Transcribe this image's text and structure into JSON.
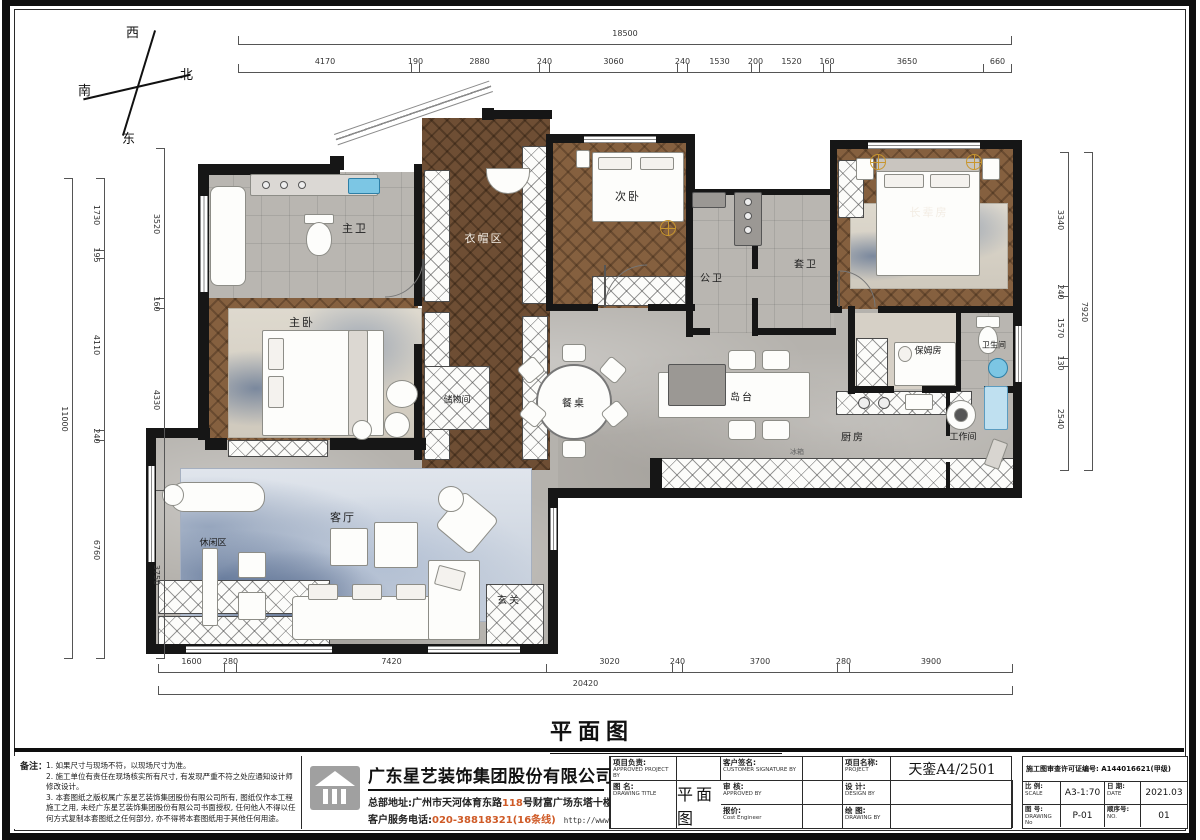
{
  "compass": {
    "west": "西",
    "north": "北",
    "south": "南",
    "east": "东"
  },
  "dims": {
    "top_total": "18500",
    "top": [
      "4170",
      "190",
      "2880",
      "240",
      "3060",
      "240",
      "1530",
      "200",
      "1520",
      "160",
      "3650",
      "660"
    ],
    "bottom_total": "20420",
    "bottom": [
      "1600",
      "280",
      "7420",
      "3020",
      "240",
      "3700",
      "280",
      "3900"
    ],
    "left_total": "11000",
    "left_outer": [
      "1730",
      "195",
      "4110",
      "240",
      "6760"
    ],
    "left_inner": [
      "3520",
      "160",
      "4330",
      "3750"
    ],
    "right_total": "7920",
    "right": [
      "3340",
      "240",
      "1570",
      "130",
      "2540"
    ]
  },
  "rooms": {
    "master_bath": "主卫",
    "cloak": "衣帽区",
    "second_bed": "次卧",
    "public_bath": "公卫",
    "suite_bath": "套卫",
    "elder_room": "长辈房",
    "master_bed": "主卧",
    "storage": "储物间",
    "dining_table": "餐桌",
    "island": "岛台",
    "nanny_room": "保姆房",
    "bathroom": "卫生间",
    "kitchen": "厨房",
    "work_room": "工作间",
    "living": "客厅",
    "leisure": "休闲区",
    "entry": "玄关",
    "fridge": "冰箱"
  },
  "title": {
    "text": "平面图",
    "scale": "1:70"
  },
  "notes": {
    "heading": "备注：",
    "line1": "1. 如果尺寸与现场不符，以现场尺寸为准。",
    "line2": "2. 施工单位有责任在现场核实所有尺寸, 有发现严重不符之处应通知设计师修改设计。",
    "line3": "3. 本套图纸之版权属广东星艺装饰集团股份有限公司所有, 图纸仅作本工程施工之用, 未经广东星艺装饰集团股份有限公司书面授权, 任何他人不得以任何方式复制本套图纸之任何部分, 亦不得将本套图纸用于其他任何用途。"
  },
  "company": {
    "name": "广东星艺装饰集团股份有限公司",
    "address_prefix": "总部地址:广州市天河体育东路",
    "address_highlight": "118",
    "address_suffix": "号财富广场东塔十楼",
    "phone_label": "客户服务电话:",
    "phone_number": "020-38818321(16条线)",
    "website": "http://www.xingyigz.com.cn"
  },
  "titleblock": {
    "approved_project_cn": "项目负责:",
    "approved_project_en": "APPROVED PROJECT BY",
    "customer_cn": "客户签名:",
    "customer_en": "CUSTOMER SIGNATURE BY",
    "review_cn": "审 核:",
    "review_en": "APPROVED BY",
    "design_cn": "设 计:",
    "design_en": "DESIGN BY",
    "cost_cn": "报价:",
    "cost_en": "Cost Engineer",
    "drawing_by_cn": "绘 图:",
    "drawing_by_en": "DRAWING BY",
    "project_cn": "项目名称:",
    "project_en": "PROJECT",
    "project_value": "天銮A4/2501",
    "drawing_title_cn": "图 名:",
    "drawing_title_en": "DRAWING  TITLE",
    "drawing_title_value": "平面图",
    "permit": "施工图审查许可证编号: A144016621(甲级)",
    "scale_cn": "比 例:",
    "scale_en": "SCALE",
    "scale_value": "A3-1:70",
    "date_cn": "日 期:",
    "date_en": "DATE",
    "date_value": "2021.03",
    "drawing_no_cn": "图 号:",
    "drawing_no_en": "DRAWING No",
    "drawing_no_value": "P-01",
    "seq_cn": "顺序号:",
    "seq_en": "NO.",
    "seq_value": "01"
  },
  "colors": {
    "wood": "#85603f",
    "marble": "#b5b2ad",
    "rug_blue": "#9db0c6",
    "accent_orange": "#cf5a26",
    "basin_blue": "#7cc6e4",
    "gold": "#c8962e"
  }
}
